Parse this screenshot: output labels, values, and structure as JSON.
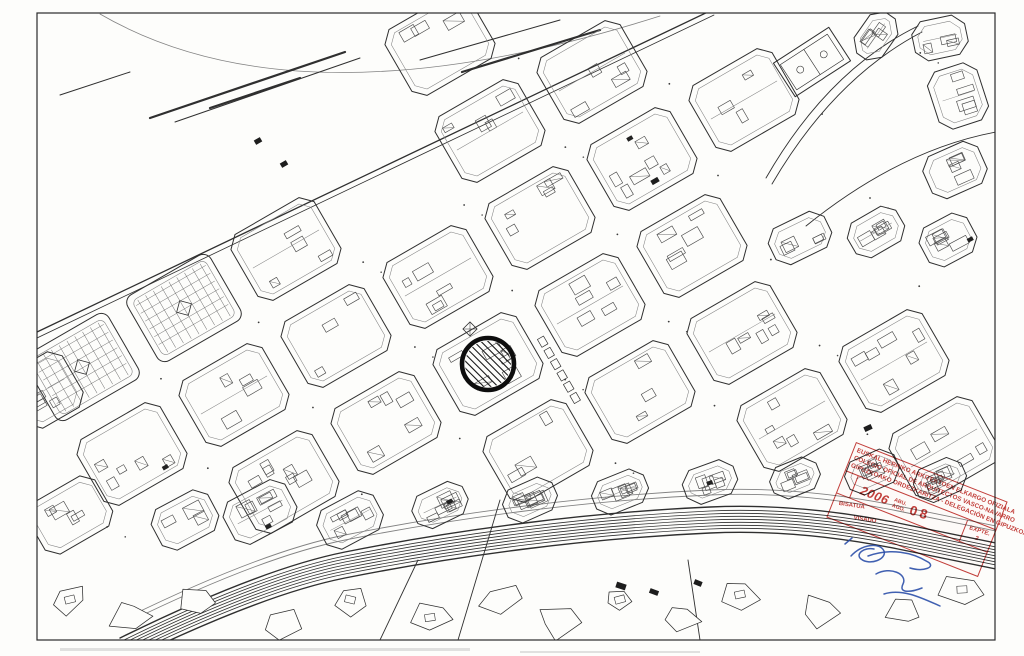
{
  "stamp": {
    "color": "#c0322e",
    "rotation_deg": 21.5,
    "line1": "EUSKAL HERRIKO ARKITEKTOEN ELKARGO OFIZIALA",
    "line2": "COLEGIO OFICIAL DE ARQUITECTOS VASCO-NAVARRO",
    "line3": "GIPUZKOAKO ORDEZKARITZA - DELEGACIÓN EN GIPUZKOA",
    "date": {
      "year": "2006",
      "month_eu": "ABU.",
      "month_es": "AGO.",
      "day": "08"
    },
    "file_label": "EXPTE.",
    "file_number": "2",
    "visa_line1": "BISATUA",
    "visa_line2": "VISADO"
  },
  "marker": {
    "x": 488,
    "y": 364,
    "r": 26,
    "stroke_width": 4.6,
    "color": "#0d0d0d",
    "hatch_spacing": 5,
    "hatch_angle": 45
  },
  "signature": {
    "color": "#2b4fa8",
    "paths": [
      "M 851 556 C 862 544 880 542 884 551 C 887 559 870 566 861 559 C 855 554 864 547 874 549",
      "M 868 556 C 890 548 912 552 928 562 C 936 567 924 572 910 568",
      "M 876 574 C 890 566 908 574 903 584 C 898 594 912 592 922 588",
      "M 884 594 C 902 588 922 598 940 606",
      "M 845 544 L 852 538"
    ]
  },
  "map_geometry": {
    "frame": {
      "x": 37,
      "y": 13,
      "w": 958,
      "h": 627
    },
    "ink": "#2f2f2f",
    "ink_light": "#828282",
    "paper": "#fdfdfb",
    "grid": {
      "origin": [
        488,
        364
      ],
      "u": [
        102,
        -59
      ],
      "v": [
        50,
        87
      ],
      "block_w": 96,
      "block_h": 76,
      "chamfer": 11,
      "angle_deg": -30,
      "i_range": [
        -6,
        6
      ],
      "j_range": [
        -5,
        5
      ]
    },
    "prom_block_xmax": 430,
    "promenade_line": {
      "x1": 37,
      "y1": 332,
      "x2": 712,
      "y2": 10
    },
    "promenade_extras": [
      [
        37,
        338,
        714,
        15
      ],
      [
        150,
        118,
        345,
        52
      ],
      [
        175,
        122,
        360,
        58
      ],
      [
        210,
        108,
        300,
        78
      ],
      [
        420,
        60,
        560,
        20
      ],
      [
        462,
        72,
        600,
        30
      ],
      [
        60,
        95,
        130,
        72
      ]
    ],
    "shore_curve": "M 100 14 Q 300 130 660 16",
    "rail_profile": [
      [
        37,
        600
      ],
      [
        260,
        560
      ],
      [
        500,
        535
      ],
      [
        750,
        516
      ],
      [
        996,
        556
      ]
    ],
    "rail_path": [
      [
        120,
        652
      ],
      [
        260,
        583
      ],
      [
        430,
        549
      ],
      [
        620,
        525
      ],
      [
        800,
        517
      ],
      [
        996,
        557
      ]
    ],
    "rail_offsets": [
      -14,
      -10,
      -7,
      -4,
      -1,
      2,
      5,
      8,
      12
    ],
    "street_offsets": [
      -26,
      -31
    ],
    "crossing_roads": [
      "M 500 500 L 458 640",
      "M 700 640 L 688 560",
      "M 380 640 L 418 560"
    ],
    "parks": [
      [
        183,
        308
      ],
      [
        81,
        367
      ]
    ],
    "park_radius": 40,
    "topright_exclude": {
      "x_min": 780,
      "y_max": 285
    },
    "topright_roads": [
      "M 766 178 Q 828 70 918 26",
      "M 772 184 Q 834 78 922 32",
      "M 806 226 Q 900 150 996 132"
    ],
    "court_block": [
      812,
      62,
      66,
      40,
      -33
    ],
    "custom_blocks": [
      [
        45,
        390,
        64,
        64,
        -30
      ],
      [
        70,
        515,
        78,
        58,
        -30
      ],
      [
        185,
        520,
        64,
        46,
        -28
      ],
      [
        260,
        512,
        70,
        48,
        -28
      ],
      [
        350,
        520,
        64,
        44,
        -28
      ],
      [
        876,
        36,
        50,
        34,
        -55
      ],
      [
        940,
        38,
        54,
        40,
        -12
      ],
      [
        958,
        96,
        52,
        60,
        -18
      ],
      [
        955,
        170,
        60,
        46,
        -24
      ],
      [
        800,
        238,
        62,
        40,
        -26
      ],
      [
        876,
        232,
        56,
        40,
        -30
      ],
      [
        948,
        240,
        54,
        44,
        -28
      ],
      [
        440,
        505,
        56,
        36,
        -26
      ],
      [
        530,
        500,
        54,
        36,
        -24
      ],
      [
        620,
        492,
        56,
        36,
        -22
      ],
      [
        710,
        482,
        54,
        36,
        -20
      ],
      [
        795,
        478,
        50,
        34,
        -22
      ],
      [
        872,
        472,
        54,
        36,
        -24
      ],
      [
        940,
        480,
        52,
        36,
        -24
      ]
    ],
    "parcel_strip": {
      "x": 540,
      "y": 338,
      "rot": 60,
      "count": 6,
      "step": 13
    },
    "mini_plaza": [
      470,
      329
    ],
    "bottom_buildings": [
      [
        70,
        600
      ],
      [
        130,
        615
      ],
      [
        200,
        600
      ],
      [
        280,
        622
      ],
      [
        350,
        600
      ],
      [
        430,
        618
      ],
      [
        500,
        598
      ],
      [
        560,
        622
      ],
      [
        620,
        600
      ],
      [
        680,
        618
      ],
      [
        740,
        595
      ],
      [
        820,
        610
      ],
      [
        905,
        612
      ],
      [
        962,
        590
      ]
    ],
    "dark_marks": [
      [
        258,
        141,
        7,
        5,
        -30
      ],
      [
        284,
        164,
        7,
        5,
        -30
      ],
      [
        655,
        181,
        8,
        5,
        -30
      ],
      [
        621,
        586,
        10,
        6,
        18
      ],
      [
        654,
        592,
        9,
        5,
        20
      ],
      [
        698,
        583,
        8,
        5,
        22
      ],
      [
        868,
        428,
        8,
        5,
        -25
      ]
    ],
    "artifacts": [
      [
        60,
        648,
        410,
        3
      ],
      [
        520,
        651,
        180,
        2
      ]
    ]
  }
}
